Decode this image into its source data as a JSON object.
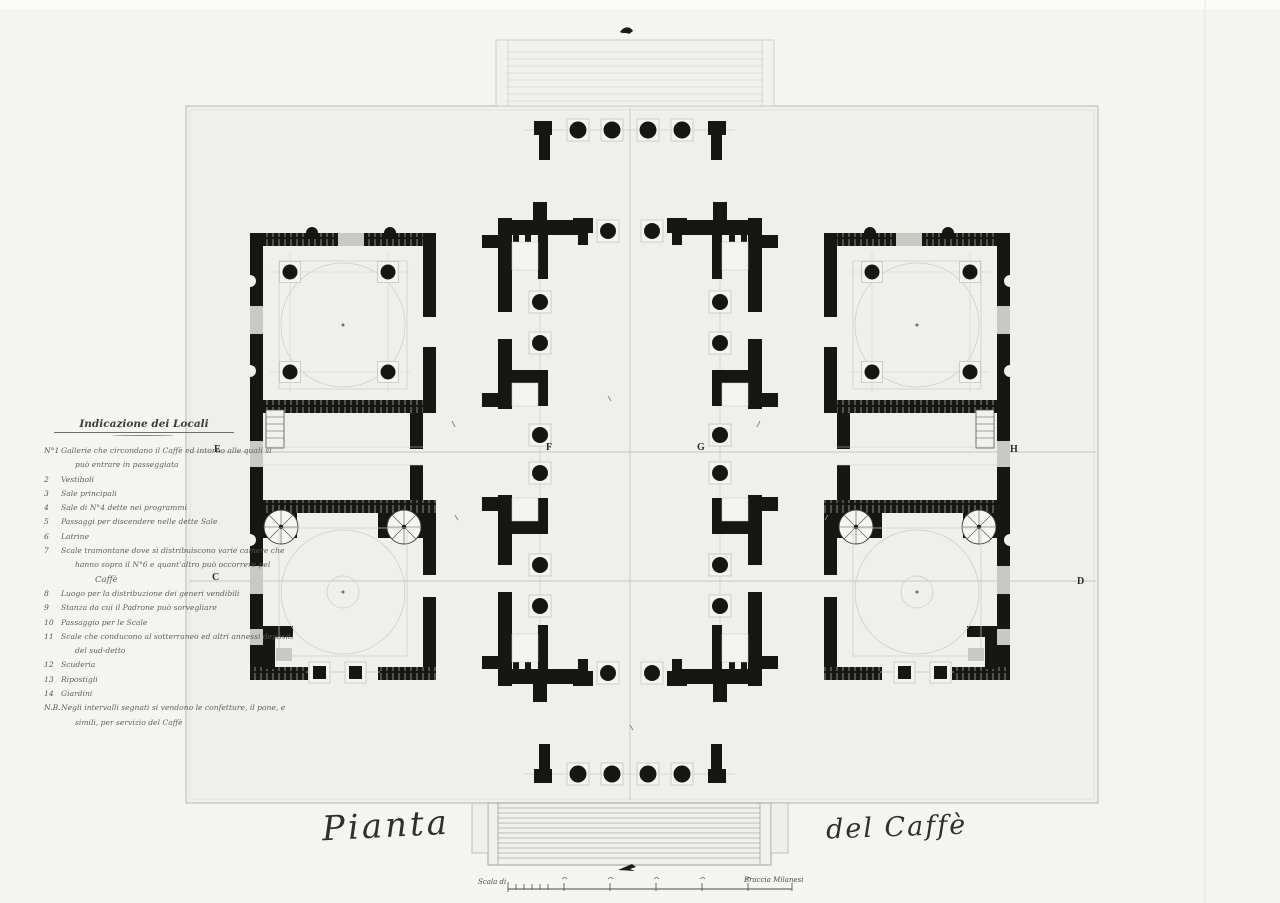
{
  "drawing": {
    "title": {
      "part1": "Pianta",
      "part2": "del Caffè"
    },
    "letters": {
      "e": "E",
      "f": "F",
      "g": "G",
      "h": "H",
      "c": "C",
      "d": "D"
    },
    "scale": {
      "left_label": "Scala di",
      "right_label": "Braccia Milanesi"
    },
    "legend": {
      "title": "Indicazione dei Locali",
      "rows": [
        {
          "num": "N°1",
          "text": "Gallerie che circondano il Caffè ed intorno alle quali si"
        },
        {
          "num": "",
          "text": "può entrare in passeggiata"
        },
        {
          "num": "2",
          "text": "Vestiboli"
        },
        {
          "num": "3",
          "text": "Sale principali"
        },
        {
          "num": "4",
          "text": "Sale di N°4 dette nei programmi"
        },
        {
          "num": "5",
          "text": "Passaggi per discendere nelle dette Sale"
        },
        {
          "num": "6",
          "text": "Latrine"
        },
        {
          "num": "7",
          "text": "Scale tramontane dove si distribuiscono varie camere che"
        },
        {
          "num": "",
          "text": "hanno sopra il N°6 e quant'altro può occorrere pel"
        },
        {
          "num": "",
          "text": "Caffè"
        },
        {
          "num": "8",
          "text": "Luogo per la distribuzione dei generi vendibili"
        },
        {
          "num": "9",
          "text": "Stanza da cui il Padrone può sorvegliare"
        },
        {
          "num": "10",
          "text": "Passaggio per le Scale"
        },
        {
          "num": "11",
          "text": "Scale che conducono al sotterraneo ed altri annessi depositi"
        },
        {
          "num": "",
          "text": "del sud-detto"
        },
        {
          "num": "12",
          "text": "Scuderia"
        },
        {
          "num": "13",
          "text": "Ripostigli"
        },
        {
          "num": "14",
          "text": "Giardini"
        },
        {
          "num": "N.B.",
          "text": "Negli intervalli segnati si vendono le confetture, il pane, e"
        },
        {
          "num": "",
          "text": "simili, per servizio del Caffè"
        }
      ]
    }
  }
}
